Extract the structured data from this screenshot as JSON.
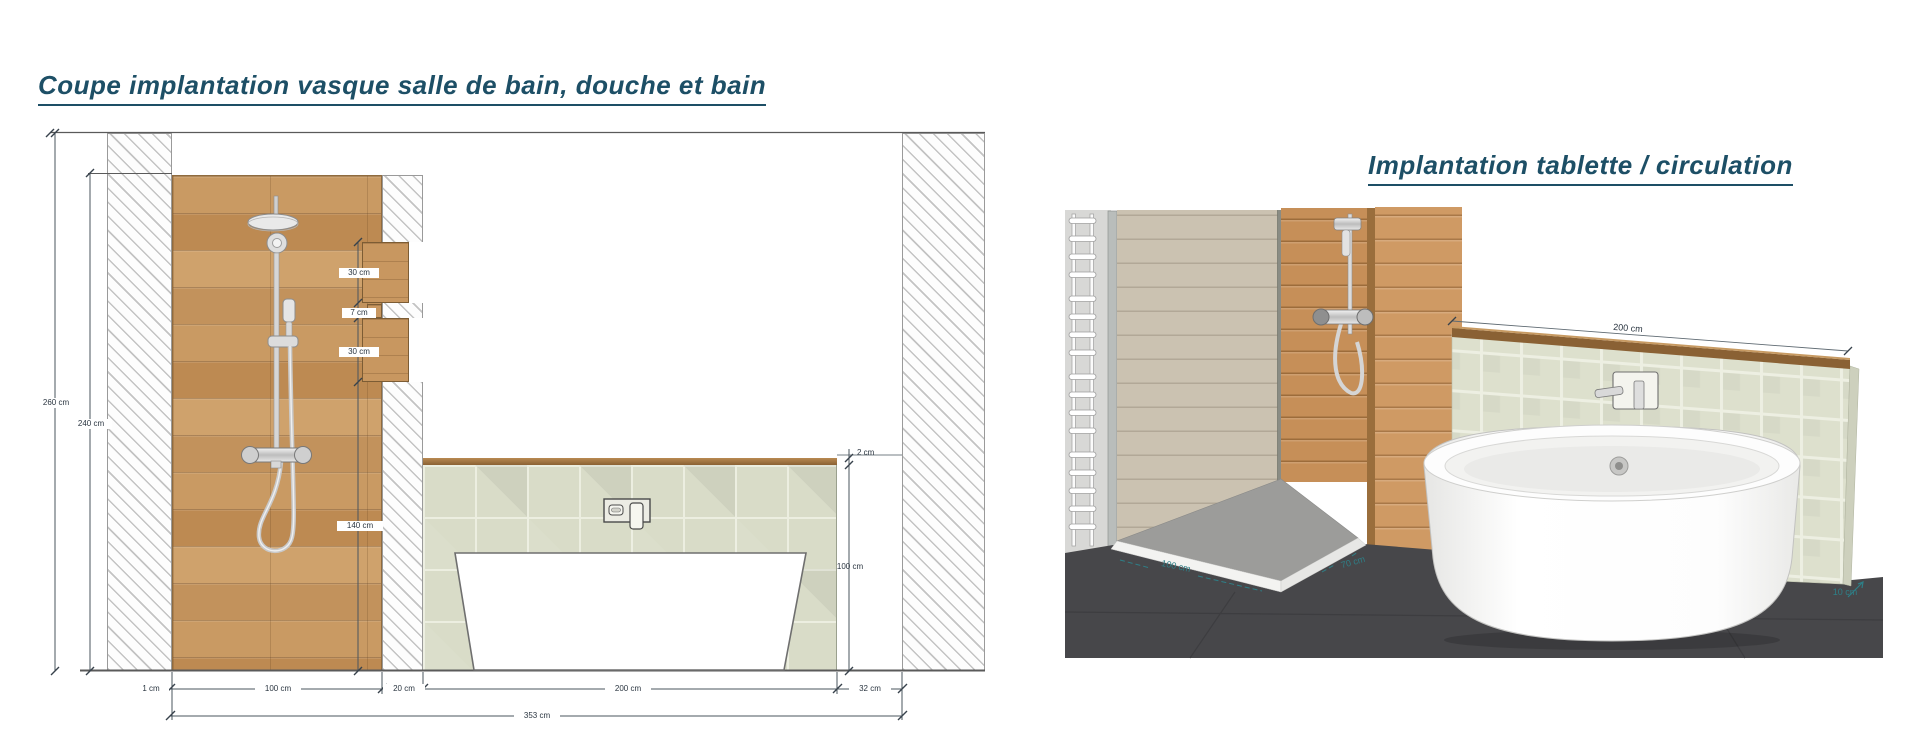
{
  "left_panel": {
    "title": "Coupe implantation vasque salle de bain, douche et bain",
    "dims": {
      "room_height": "260 cm",
      "panel_height": "240 cm",
      "niche_upper": "30 cm",
      "niche_gap": "7 cm",
      "niche_lower": "30 cm",
      "valve_height": "140 cm",
      "shelf_thickness": "2 cm",
      "pony_wall_height": "100 cm",
      "gap_left": "1 cm",
      "shower_width": "100 cm",
      "partition_width": "20 cm",
      "bath_zone_width": "200 cm",
      "gap_right": "32 cm",
      "total_width": "353 cm"
    }
  },
  "right_panel": {
    "title": "Implantation tablette / circulation",
    "dims": {
      "tray_width": "100 cm",
      "tray_depth": "70 cm",
      "shelf_length": "200 cm",
      "shelf_offset": "10 cm"
    }
  },
  "colors": {
    "title_text": "#1d4f66",
    "dim_text": "#2a3540",
    "dim_teal": "#2e7f87",
    "wood": "#c59a63",
    "tile": "#dcdfcd",
    "floor_dark": "#47474a"
  }
}
